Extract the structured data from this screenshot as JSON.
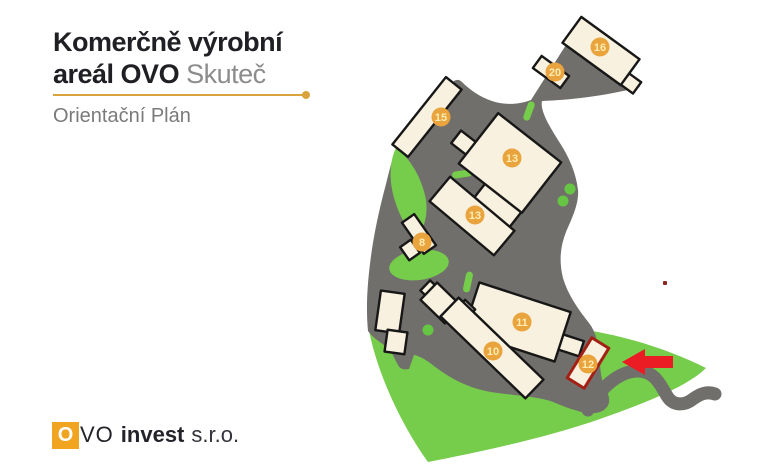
{
  "header": {
    "title_line1": "Komerčně výrobní",
    "title_line2_bold": "areál OVO",
    "title_line2_light": "Skuteč",
    "subtitle": "Orientační Plán"
  },
  "footer": {
    "logo_o": "O",
    "logo_vo": "VO",
    "logo_invest": "invest",
    "logo_suffix": "s.r.o."
  },
  "map": {
    "highlighted_building": "12",
    "badges": [
      {
        "label": "16",
        "x": 600,
        "y": 47
      },
      {
        "label": "20",
        "x": 555,
        "y": 72
      },
      {
        "label": "15",
        "x": 441,
        "y": 117
      },
      {
        "label": "13",
        "x": 512,
        "y": 158
      },
      {
        "label": "13",
        "x": 475,
        "y": 215
      },
      {
        "label": "8",
        "x": 422,
        "y": 242
      },
      {
        "label": "11",
        "x": 522,
        "y": 322
      },
      {
        "label": "10",
        "x": 493,
        "y": 351
      },
      {
        "label": "12",
        "x": 588,
        "y": 364
      }
    ],
    "colors": {
      "paved": "#716F6B",
      "green": "#76CC4B",
      "tree": "#66C643",
      "building": "#F8F1DF",
      "outline": "#171717",
      "badge": "#E9A43D",
      "badge_text": "#FFEDB4",
      "highlight": "#A32015",
      "arrow": "#EB1C23",
      "accent": "#D9A43B",
      "logo_orange": "#F0A41F"
    }
  }
}
